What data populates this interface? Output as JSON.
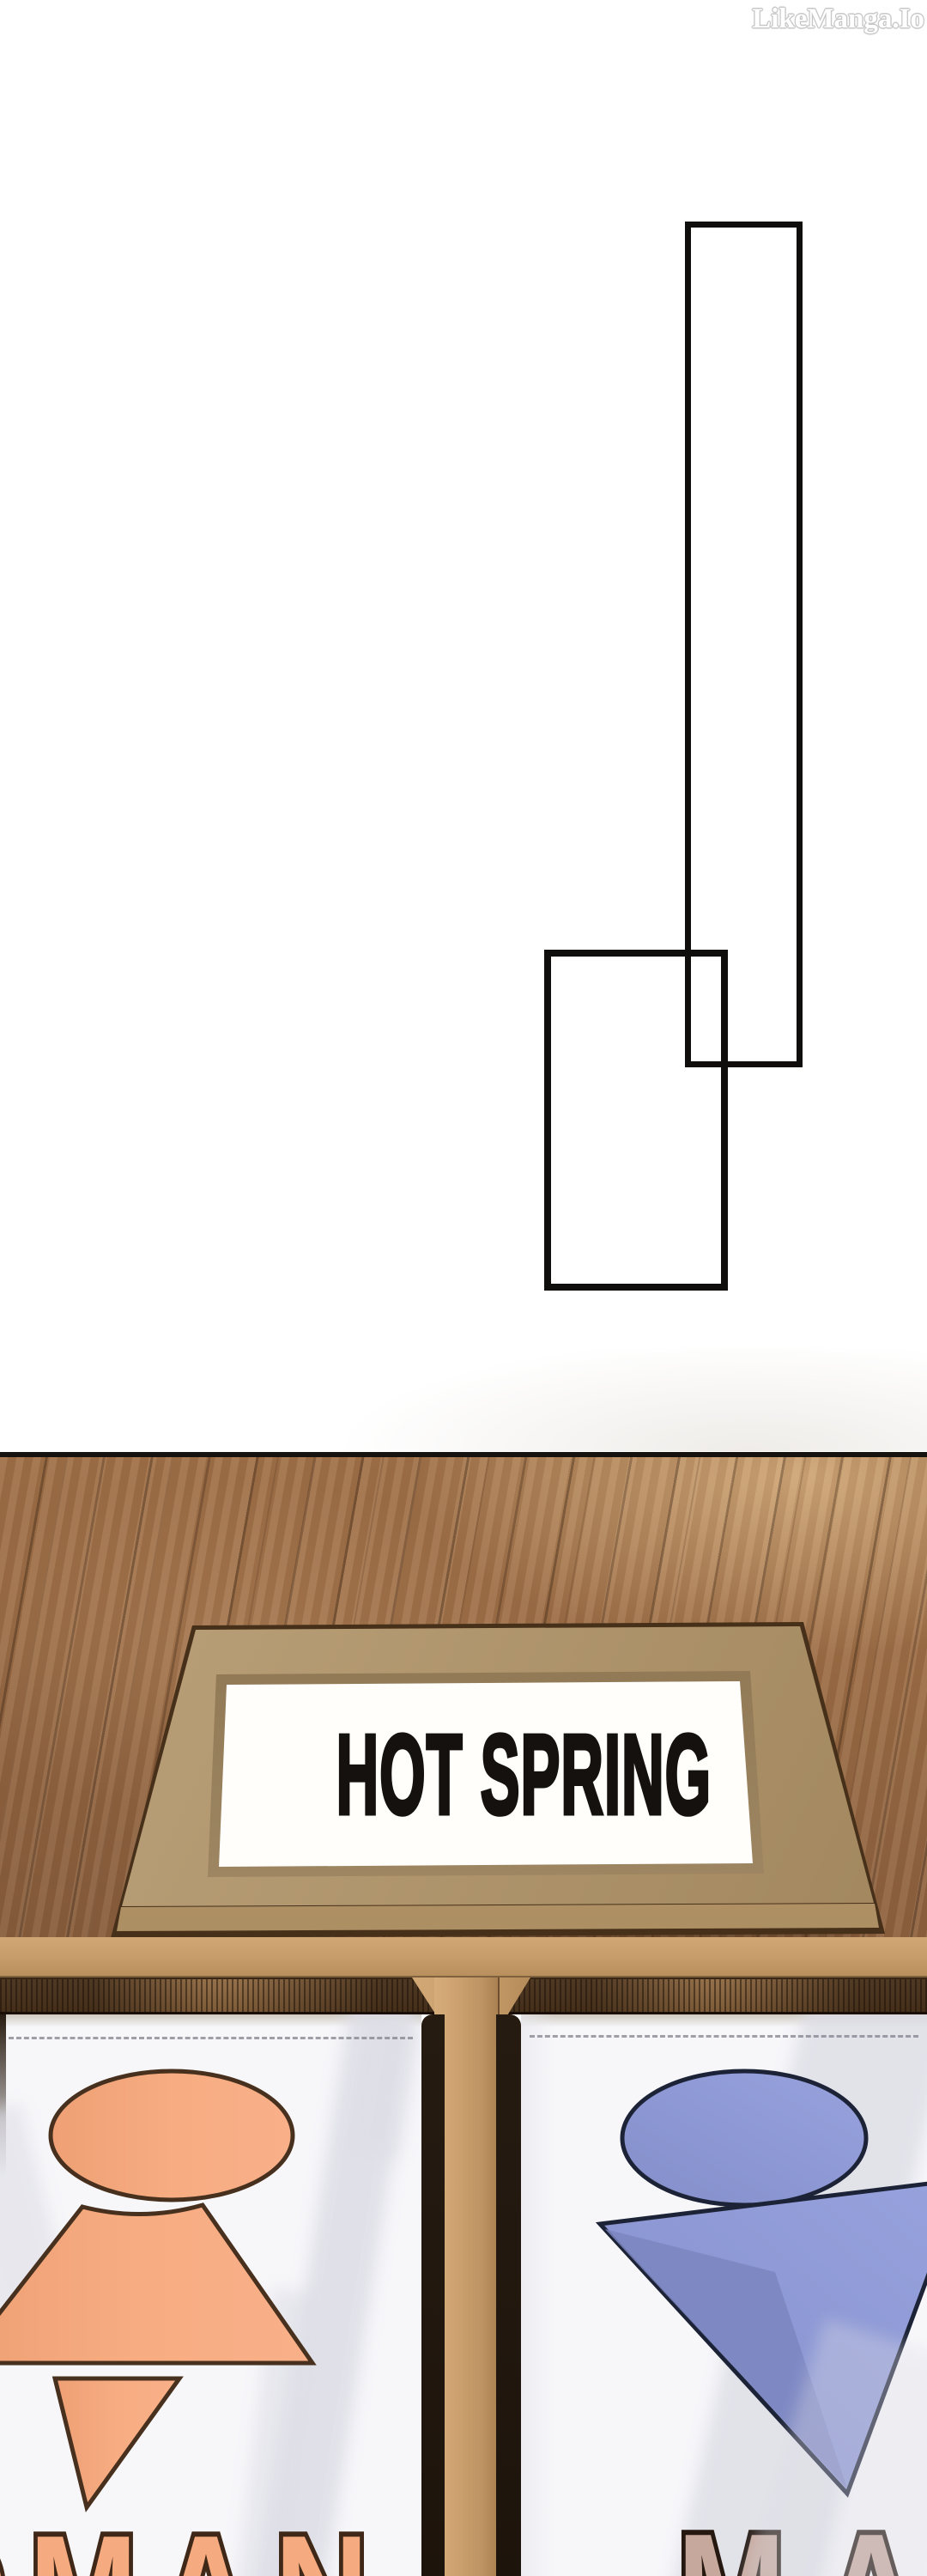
{
  "watermark": {
    "text": "LikeManga.Io"
  },
  "panels": {
    "count": 2,
    "description": "two overlapping empty rectangular panel outlines",
    "outline_color": "#0f0e0c"
  },
  "sign": {
    "text": "HOT SPRING",
    "frame_color": "#b79d75",
    "panel_color": "#fffefb",
    "text_color": "#14110e"
  },
  "banners": {
    "left": {
      "word": "WOMAN",
      "symbol": "woman-symbol",
      "symbol_color": "#f6aa7f",
      "symbol_outline": "#47301d",
      "word_fill": "#f6aa7f",
      "word_outline": "#3f2817"
    },
    "right": {
      "word": "MAN",
      "symbol": "man-symbol",
      "symbol_color": "#8e99d5",
      "symbol_outline": "#1d2337",
      "word_fill": "#c6a89c",
      "word_outline": "#241811"
    }
  },
  "scene": {
    "floor_color": "#9c6f47",
    "beam_color": "#c59c6a",
    "cloth_color": "#f7f7fa",
    "lintel_color": "#7d5b38"
  }
}
